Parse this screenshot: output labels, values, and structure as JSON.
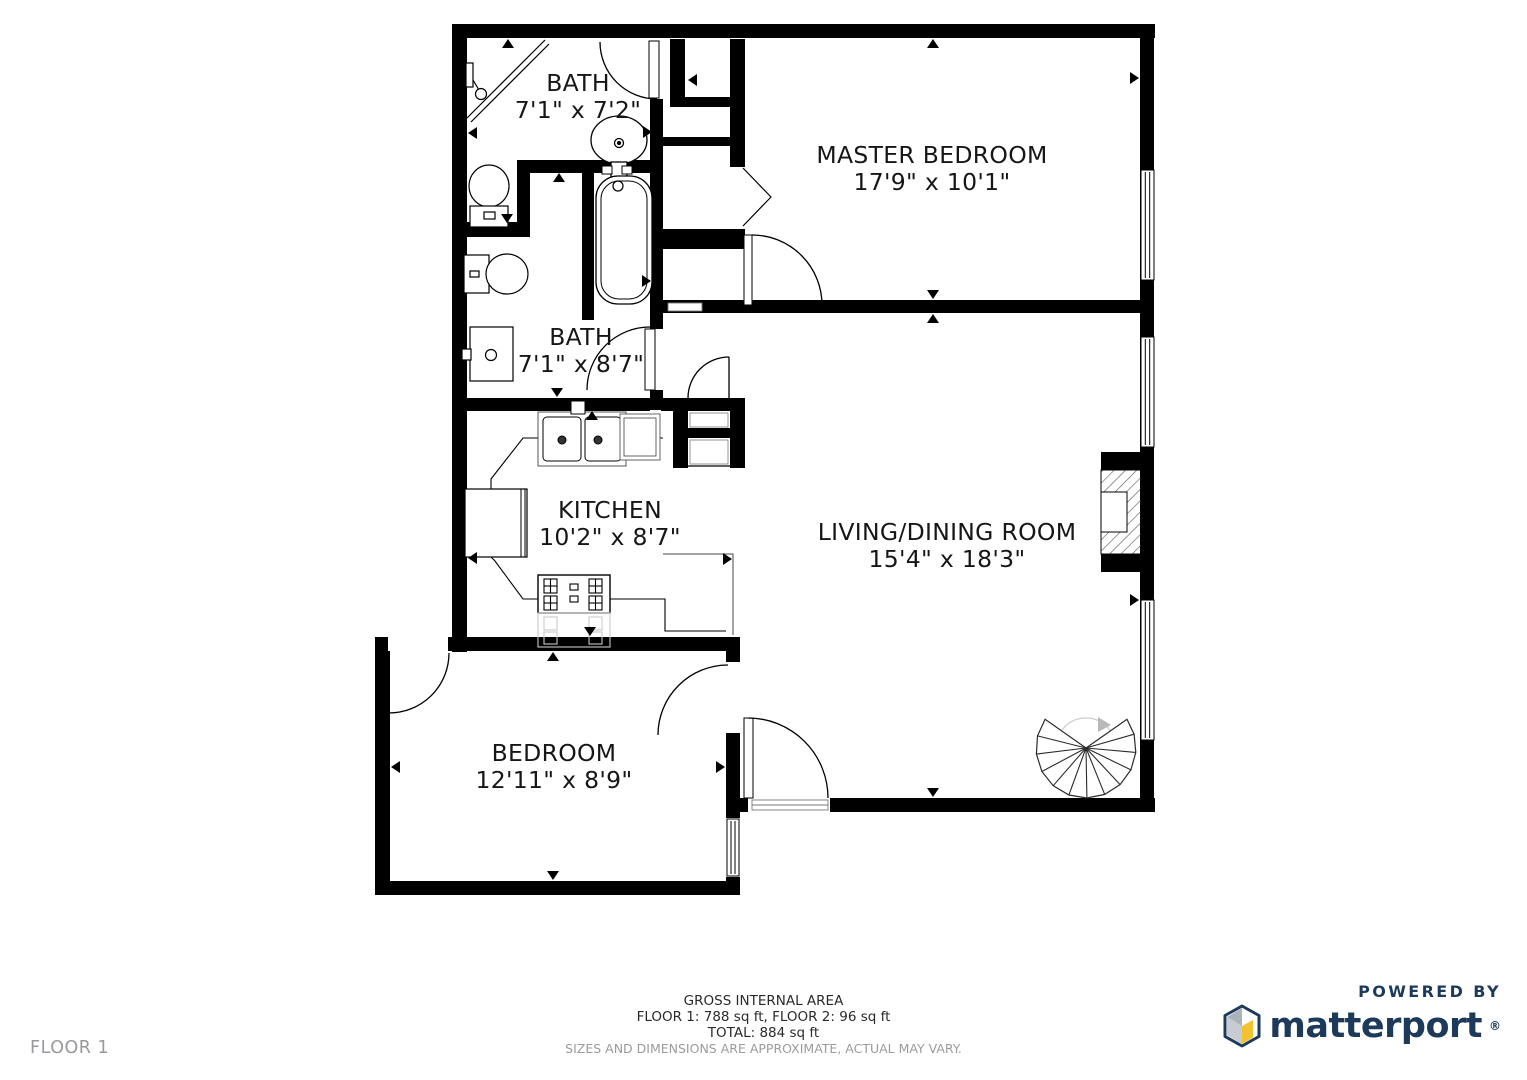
{
  "rooms": [
    {
      "id": "bath-1",
      "name": "BATH",
      "dims": "7'1\" x 7'2\""
    },
    {
      "id": "master-bedroom",
      "name": "MASTER BEDROOM",
      "dims": "17'9\" x 10'1\""
    },
    {
      "id": "bath-2",
      "name": "BATH",
      "dims": "7'1\" x 8'7\""
    },
    {
      "id": "kitchen",
      "name": "KITCHEN",
      "dims": "10'2\" x 8'7\""
    },
    {
      "id": "living-dining",
      "name": "LIVING/DINING ROOM",
      "dims": "15'4\" x 18'3\""
    },
    {
      "id": "bedroom",
      "name": "BEDROOM",
      "dims": "12'11\" x 8'9\""
    }
  ],
  "footer": {
    "area_title": "GROSS INTERNAL AREA",
    "area_line1": "FLOOR 1: 788 sq ft, FLOOR 2: 96 sq ft",
    "area_line2": "TOTAL: 884 sq ft",
    "disclaimer": "SIZES AND DIMENSIONS ARE APPROXIMATE, ACTUAL MAY VARY.",
    "floor_label": "FLOOR 1"
  },
  "branding": {
    "powered_by": "POWERED BY",
    "brand_name": "matterport",
    "registered_mark": "®"
  },
  "colors": {
    "wall": "#000000",
    "text": "#161616",
    "muted": "#9b9b9b",
    "brand_navy": "#1d3a5a",
    "brand_yellow": "#f2c230",
    "brand_gray": "#aab3ba"
  }
}
